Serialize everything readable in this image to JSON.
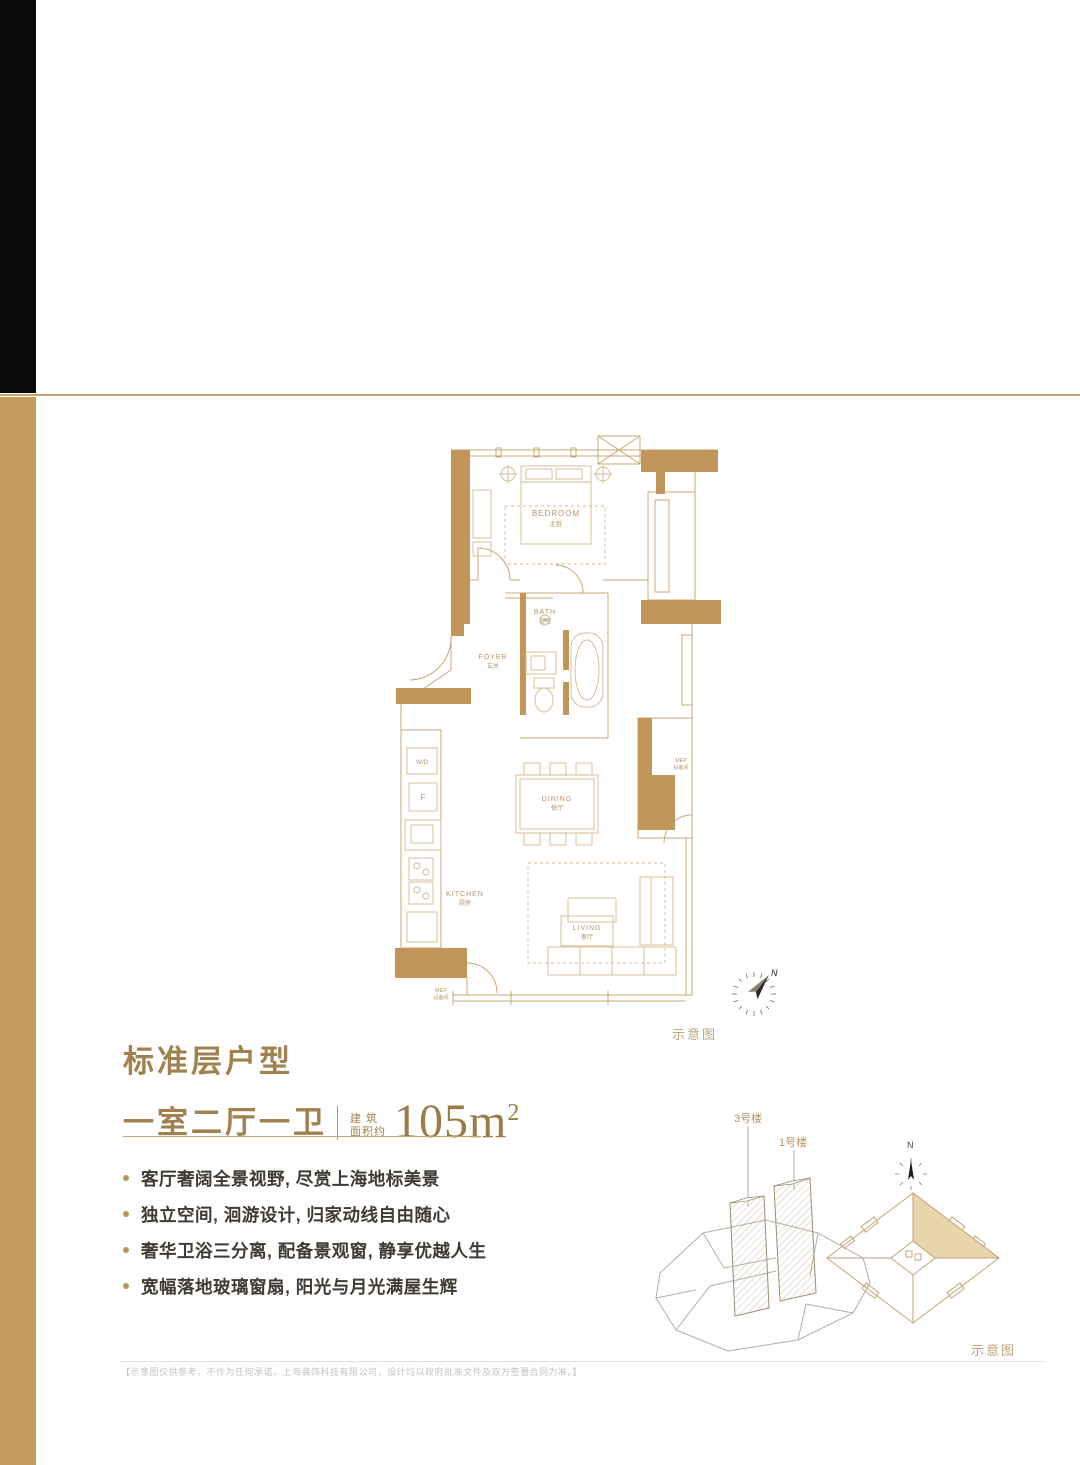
{
  "colors": {
    "accent_gold": "#c49a5f",
    "gold_line": "#c9a36b",
    "bronze_text": "#a1824e",
    "dark_text": "#3f3a33",
    "plan_wall_fill": "#c2965a",
    "plan_line": "#c9a877",
    "plan_label": "#b89566"
  },
  "title_block": {
    "heading": "标准层户型",
    "layout": "一室二厅一卫",
    "area_label_line1": "建 筑",
    "area_label_line2": "面积约",
    "area_value": "105m",
    "area_sup": "2"
  },
  "features": [
    "客厅奢阔全景视野, 尽赏上海地标美景",
    "独立空间, 洄游设计, 归家动线自由随心",
    "奢华卫浴三分离, 配备景观窗, 静享优越人生",
    "宽幅落地玻璃窗扇, 阳光与月光满屋生辉"
  ],
  "floor_plan": {
    "caption": "示意图",
    "compass_n": "N",
    "rooms": {
      "bedroom_en": "BEDROOM",
      "bedroom_zh": "主卧",
      "bath_en": "BATH",
      "bath_zh": "浴室",
      "foyer_en": "FOYER",
      "foyer_zh": "玄关",
      "dining_en": "DINING",
      "dining_zh": "餐厅",
      "living_en": "LIVING",
      "living_zh": "客厅",
      "kitchen_en": "KITCHEN",
      "kitchen_zh": "厨房",
      "wd": "W/D",
      "fridge": "F",
      "mep_en": "MEP",
      "mep_zh": "设备间",
      "mep2_en": "MEP",
      "mep2_zh": "设备间"
    }
  },
  "site_diagram": {
    "tower_left_label": "3号楼",
    "tower_right_label": "1号楼",
    "compass_n": "N",
    "caption": "示意图"
  },
  "footer": {
    "disclaimer": "【示意图仅供参考，不作为任何承诺。上海装饰科技有限公司，设计均以政府批准文件及双方签署合同为准。】"
  }
}
